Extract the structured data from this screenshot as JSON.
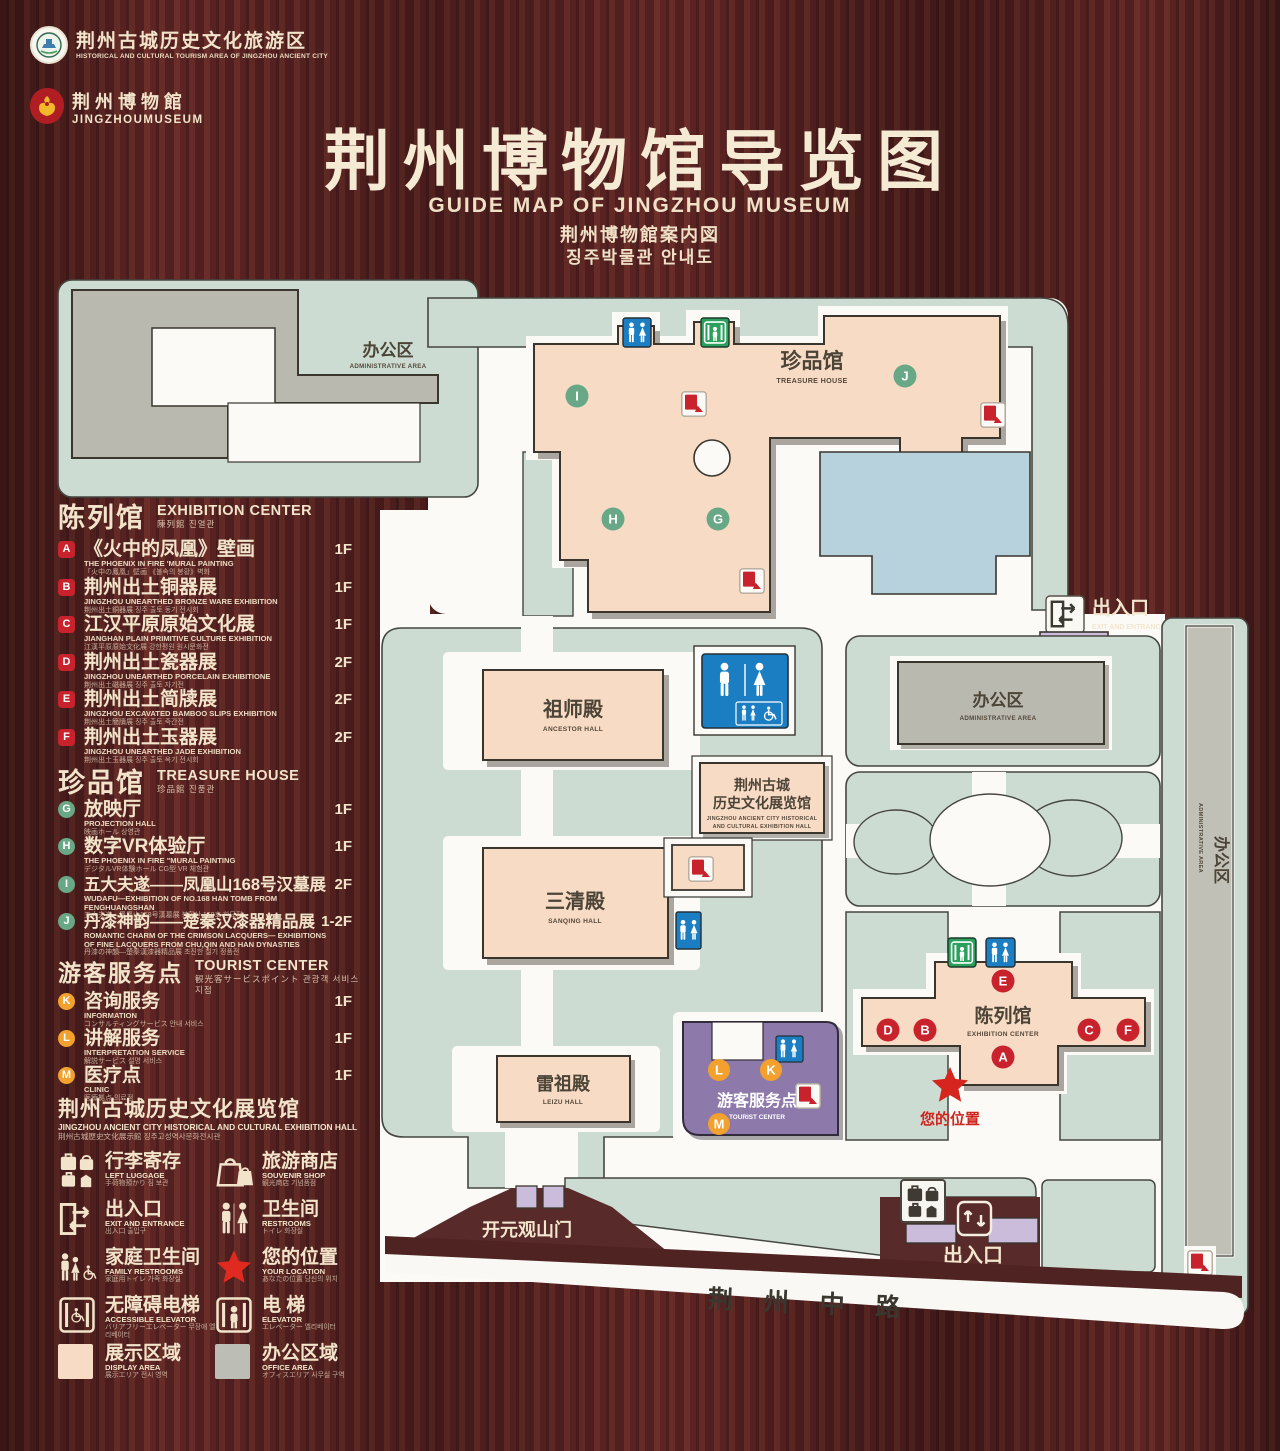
{
  "header": {
    "logo1_zh": "荆州古城历史文化旅游区",
    "logo1_en": "HISTORICAL AND CULTURAL TOURISM AREA OF JINGZHOU ANCIENT CITY",
    "logo2_zh": "荆州博物館",
    "logo2_en": "JINGZHOUMUSEUM",
    "title": "荆州博物馆导览图",
    "subtitle_en": "GUIDE MAP OF JINGZHOU MUSEUM",
    "subtitle_ja": "荆州博物館案内図",
    "subtitle_ko": "징주박물관 안내도"
  },
  "legend": {
    "exhibition": {
      "title_zh": "陈列馆",
      "title_en": "EXHIBITION CENTER",
      "title_sub": "陳列館  진열관",
      "items": [
        {
          "letter": "A",
          "zh": "《火中的凤凰》壁画",
          "en": "THE PHOENIX IN FIRE 'MURAL PAINTING",
          "sub": "「火中の鳳凰」壁画 《불속의 봉황》벽화",
          "floor": "1F"
        },
        {
          "letter": "B",
          "zh": "荆州出土铜器展",
          "en": "JINGZHOU UNEARTHED BRONZE WARE EXHIBITION",
          "sub": "荆州出土銅器展  징주 출토 동기 전시회",
          "floor": "1F"
        },
        {
          "letter": "C",
          "zh": "江汉平原原始文化展",
          "en": "JIANGHAN PLAIN PRIMITIVE CULTURE EXHIBITION",
          "sub": "江漢平原原始文化展  강한평원 원시문화전",
          "floor": "1F"
        },
        {
          "letter": "D",
          "zh": "荆州出土瓷器展",
          "en": "JINGZHOU UNEARTHED PORCELAIN EXHIBITIONE",
          "sub": "荆州出土磁器展  징주 출토 자기전",
          "floor": "2F"
        },
        {
          "letter": "E",
          "zh": "荆州出土简牍展",
          "en": "JINGZHOU EXCAVATED BAMBOO SLIPS EXHIBITION",
          "sub": "荆州出土簡牘展  징주 출토 죽간전",
          "floor": "2F"
        },
        {
          "letter": "F",
          "zh": "荆州出土玉器展",
          "en": "JINGZHOU UNEARTHED JADE EXHIBITION",
          "sub": "荆州出土玉器展  징주 출토 옥기 전시회",
          "floor": "2F"
        }
      ]
    },
    "treasure": {
      "title_zh": "珍品馆",
      "title_en": "TREASURE HOUSE",
      "title_sub": "珍品館  진품관",
      "items": [
        {
          "letter": "G",
          "zh": "放映厅",
          "en": "PROJECTION HALL",
          "sub": "映画ホール  상영관",
          "floor": "1F"
        },
        {
          "letter": "H",
          "zh": "数字VR体验厅",
          "en": "THE PHOENIX IN FIRE \"MURAL PAINTING",
          "sub": "デジタルVR体験ホール  CG型 VR 체험관",
          "floor": "1F"
        },
        {
          "letter": "I",
          "zh": "五大夫遂——凤凰山168号汉墓展",
          "en": "WUDAFU—EXHIBITION OF NO.168 HAN TOMB FROM FENGHUANGSHAN",
          "sub": "五大夫遂—鳳凰山168号漢墓展  봉황산 168호 한묘전",
          "floor": "2F"
        },
        {
          "letter": "J",
          "zh": "丹漆神韵——楚秦汉漆器精品展",
          "en": "ROMANTIC CHARM OF THE CRIMSON LACQUERS— EXHIBITIONS OF FINE LACQUERS FROM CHU,QIN AND HAN DYNASTIES",
          "sub": "丹漆の神韻—楚秦漢漆器精品展  초진한 칠기 정품전",
          "floor": "1-2F"
        }
      ]
    },
    "tourist": {
      "title_zh": "游客服务点",
      "title_en": "TOURIST CENTER",
      "title_sub": "観光客サービスポイント  관광객 서비스 지점",
      "items": [
        {
          "letter": "K",
          "zh": "咨询服务",
          "en": "INFORMATION",
          "sub": "コンサルティングサービス  안내 서비스",
          "floor": "1F"
        },
        {
          "letter": "L",
          "zh": "讲解服务",
          "en": "INTERPRETATION SERVICE",
          "sub": "解説サービス  설명 서비스",
          "floor": "1F"
        },
        {
          "letter": "M",
          "zh": "医疗点",
          "en": "CLINIC",
          "sub": "医療拠点  의료점",
          "floor": "1F"
        }
      ]
    },
    "jz_hall": {
      "zh": "荆州古城历史文化展览馆",
      "en": "JINGZHOU ANCIENT CITY HISTORICAL AND CULTURAL EXHIBITION HALL",
      "sub": "荆州古城歴史文化展示館      징주고성역사문화전시관"
    },
    "facilities": [
      {
        "zh": "行李寄存",
        "en": "LEFT LUGGAGE",
        "sub": "手荷物預かり  짐 보관"
      },
      {
        "zh": "旅游商店",
        "en": "SOUVENIR SHOP",
        "sub": "観光商店  기념품점"
      },
      {
        "zh": "出入口",
        "en": "EXIT AND ENTRANCE",
        "sub": "出入口  출입구"
      },
      {
        "zh": "卫生间",
        "en": "RESTROOMS",
        "sub": "トイレ  화장실"
      },
      {
        "zh": "家庭卫生间",
        "en": "FAMILY RESTROOMS",
        "sub": "家庭用トイレ  가족 화장실"
      },
      {
        "zh": "您的位置",
        "en": "YOUR LOCATION",
        "sub": "あなたの位置  당신의 위치"
      },
      {
        "zh": "无障碍电梯",
        "en": "ACCESSIBLE ELEVATOR",
        "sub": "バリアフリーエレベーター  무장애 엘리베이터"
      },
      {
        "zh": "电  梯",
        "en": "ELEVATOR",
        "sub": "エレベーター  엘리베이터"
      },
      {
        "zh": "展示区域",
        "en": "DISPLAY AREA",
        "sub": "展示エリア  전시 영역"
      },
      {
        "zh": "办公区域",
        "en": "OFFICE AREA",
        "sub": "オフィスエリア  사무실 구역"
      }
    ]
  },
  "map": {
    "areas": {
      "admin_top_left": {
        "zh": "办公区",
        "en": "ADMINISTRATIVE AREA"
      },
      "treasure_house": {
        "zh": "珍品馆",
        "en": "TREASURE HOUSE"
      },
      "ancestor_hall": {
        "zh": "祖师殿",
        "en": "ANCESTOR HALL"
      },
      "sanqing_hall": {
        "zh": "三清殿",
        "en": "SANQING HALL"
      },
      "leizu_hall": {
        "zh": "雷祖殿",
        "en": "LEIZU HALL"
      },
      "jz_hall": {
        "zh1": "荆州古城",
        "zh2": "历史文化展览馆",
        "en1": "JINGZHOU ANCIENT CITY HISTORICAL",
        "en2": "AND CULTURAL EXHIBITION HALL"
      },
      "admin_right": {
        "zh": "办公区",
        "en": "ADMINISTRATIVE AREA"
      },
      "admin_strip": {
        "zh": "办公区",
        "en": "ADMINISTRATIVE AREA"
      },
      "exhibition_center": {
        "zh": "陈列馆",
        "en": "EXHIBITION CENTER"
      },
      "tourist_center": {
        "zh": "游客服务点",
        "en": "TOURIST CENTER"
      },
      "kaiyuan_gate": {
        "zh": "开元观山门",
        "en": "KAIYUAN TEMPLE GATE"
      },
      "exit_top": {
        "zh": "出入口",
        "en": "EXIT AND ENTRANCE"
      },
      "exit_bottom": {
        "zh": "出入口",
        "en": "EXIT AND ENTRANCE"
      },
      "your_location": {
        "zh": "您的位置"
      },
      "road": {
        "zh": "荆 州 中 路"
      }
    },
    "letters": {
      "A": "A",
      "B": "B",
      "C": "C",
      "D": "D",
      "E": "E",
      "F": "F",
      "G": "G",
      "H": "H",
      "I": "I",
      "J": "J",
      "K": "K",
      "L": "L",
      "M": "M"
    }
  },
  "colors": {
    "display_area": "#f8dbc5",
    "office_area": "#bcbdb4",
    "accent_red": "#c8232c",
    "badge_green": "#69a886",
    "badge_orange": "#f2a12e",
    "sign_blue": "#1b7ec2",
    "sign_green": "#2aa05c"
  }
}
